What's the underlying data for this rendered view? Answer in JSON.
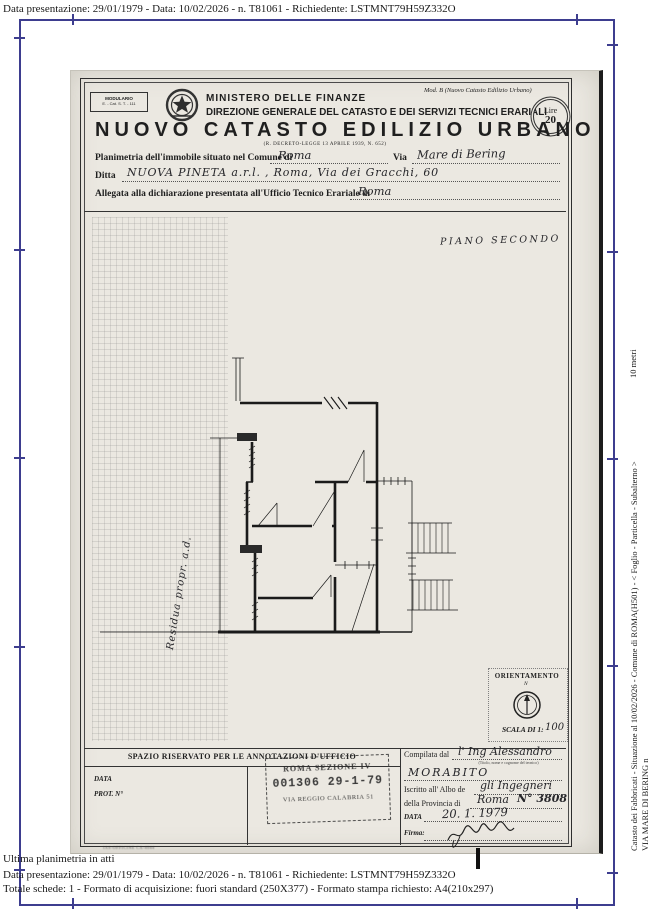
{
  "colors": {
    "frame": "#3d3d8f",
    "paper": "#ebe8e1",
    "ink": "#1f1f1f"
  },
  "viewer": {
    "top_line": "Data presentazione: 29/01/1979 - Data: 10/02/2026 - n. T81061 - Richiedente: LSTMNT79H59Z332O",
    "bottom": {
      "ultima": "Ultima planimetria in atti",
      "imprint": "IAS-OFFICINE CA-4044",
      "line2": "Data presentazione: 29/01/1979 - Data: 10/02/2026 - n. T81061 - Richiedente: LSTMNT79H59Z332O",
      "line3": "Totale schede: 1 - Formato di acquisizione: fuori standard (250X377) - Formato stampa richiesto: A4(210x297)"
    },
    "right_margin": {
      "scale_label": "10 metri",
      "catasto_line": "Catasto dei Fabbricati - Situazione al 10/02/2026 - Comune di ROMA(H501) - <  Foglio   - Particella   - Subalterno   >",
      "address_line": "VIA MARE DI BERING n"
    }
  },
  "document": {
    "modulario": {
      "line1": "MODULARIO",
      "line2": "E. - Cat. S. T. - 111"
    },
    "mod_b": "Mod. B (Nuovo Catasto Edilizio Urbano)",
    "ministero": "MINISTERO DELLE FINANZE",
    "direzione": "DIREZIONE GENERALE DEL CATASTO E DEI SERVIZI TECNICI ERARIALI",
    "bollo": {
      "line1": "Lire",
      "line2": "20"
    },
    "title": "NUOVO CATASTO EDILIZIO URBANO",
    "subtitle": "(R. DECRETO-LEGGE 13 APRILE 1939, N. 652)",
    "fields": {
      "f1_label": "Planimetria dell'immobile situato nel Comune di",
      "f1_value": "Roma",
      "f1_label2": "Via",
      "f1_value2": "Mare di Bering",
      "f2_label": "Ditta",
      "f2_value": "NUOVA PINETA a.r.l. , Roma, Via dei Gracchi, 60",
      "f3_label": "Allegata alla dichiarazione presentata all'Ufficio Tecnico Erariale di",
      "f3_value": "Roma"
    },
    "plan": {
      "floor_label": "PIANO SECONDO",
      "margin_note": "Residua propr. a.d."
    },
    "orientation": {
      "title": "ORIENTAMENTO",
      "north": "N",
      "scale_label": "SCALA DI 1:",
      "scale_value": "100"
    },
    "annotations": {
      "header": "SPAZIO RISERVATO PER LE ANNOTAZIONI D'UFFICIO",
      "data_label": "DATA",
      "prot_label": "PROT. N°",
      "stamp": {
        "line1": "ROMA SEZIONE IV",
        "line2": "001306  29-1-79",
        "line3": "VIA REGGIO CALABRIA 51"
      }
    },
    "compiler": {
      "label": "Compilata dal",
      "value": "l' Ing  Alessandro",
      "value2": "MORABITO",
      "note": "(Titolo, nome e cognome del tecnico)",
      "albo_label": "Iscritto all' Albo de",
      "albo_value": "gli Ingegneri",
      "prov_label": "della Provincia di",
      "prov_value": "Roma",
      "albo_num": "N° 3808",
      "date_label": "DATA",
      "date_value": "20. 1. 1979",
      "firma_label": "Firma:"
    }
  }
}
